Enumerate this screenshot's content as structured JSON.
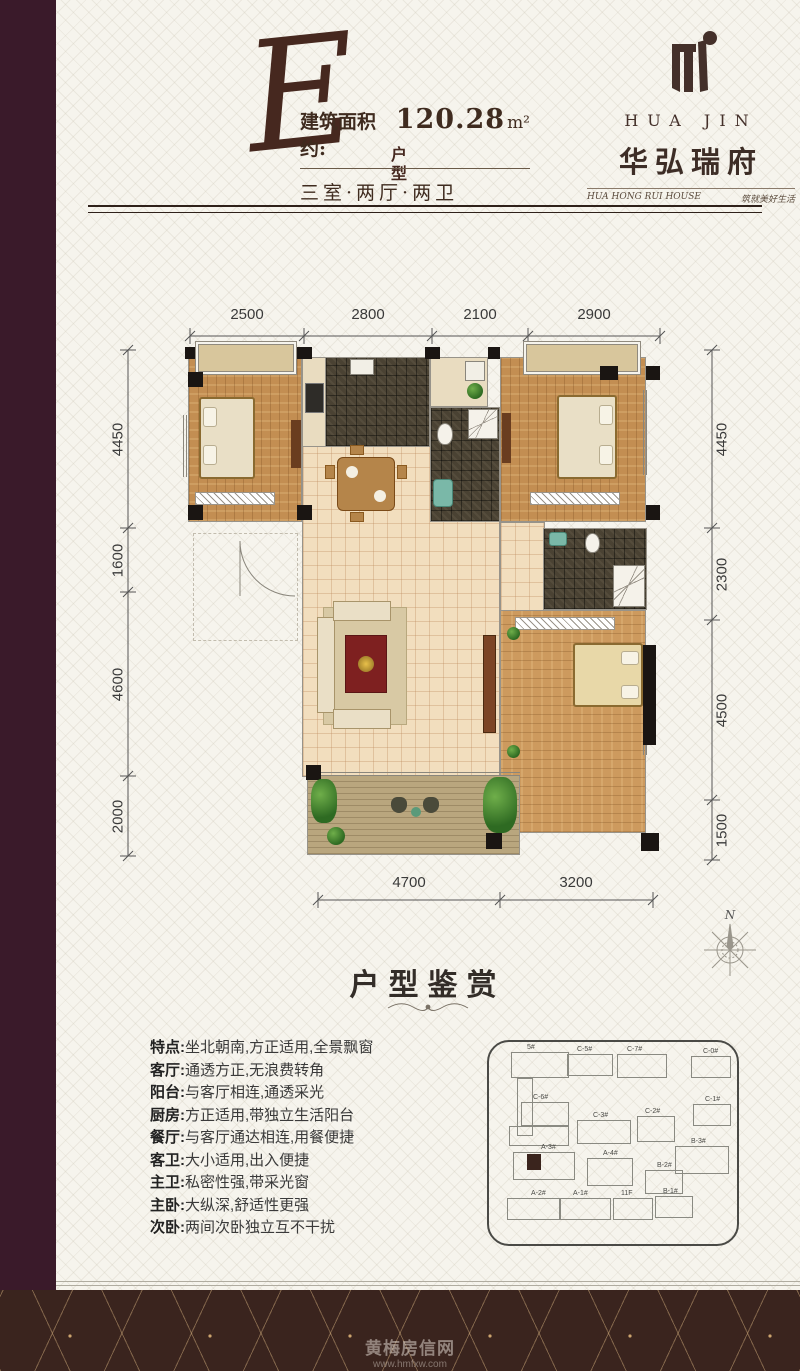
{
  "colors": {
    "accent_brown": "#46281f",
    "footer_bg": "#3a241e",
    "highlight_unit": "#3a241d"
  },
  "header": {
    "unit_letter": "E",
    "unit_suffix": "户型",
    "area_label": "建筑面积约:",
    "area_value": "120.28",
    "area_unit": "m²",
    "layout": "三室·两厅·两卫"
  },
  "brand": {
    "logo_icon": "hua-jin-monogram",
    "name_en": "HUA JIN",
    "name_cn": "华弘瑞府",
    "tagline_en": "HUA HONG RUI HOUSE",
    "tagline_cn": "筑就美好生活"
  },
  "floorplan": {
    "compass": "N",
    "dims_top": [
      "2500",
      "2800",
      "2100",
      "2900"
    ],
    "dims_left": [
      "4450",
      "1600",
      "4600",
      "2000"
    ],
    "dims_right": [
      "4450",
      "2300",
      "4500",
      "1500"
    ],
    "dims_bottom": [
      "4700",
      "3200"
    ]
  },
  "appreciation": {
    "title": "户型鉴赏",
    "features": [
      {
        "label": "特点:",
        "text": "坐北朝南,方正适用,全景飘窗"
      },
      {
        "label": "客厅:",
        "text": "通透方正,无浪费转角"
      },
      {
        "label": "阳台:",
        "text": "与客厅相连,通透采光"
      },
      {
        "label": "厨房:",
        "text": "方正适用,带独立生活阳台"
      },
      {
        "label": "餐厅:",
        "text": "与客厅通达相连,用餐便捷"
      },
      {
        "label": "客卫:",
        "text": "大小适用,出入便捷"
      },
      {
        "label": "主卫:",
        "text": "私密性强,带采光窗"
      },
      {
        "label": "主卧:",
        "text": "大纵深,舒适性更强"
      },
      {
        "label": "次卧:",
        "text": "两间次卧独立互不干扰"
      }
    ]
  },
  "siteplan": {
    "buildings": [
      "5#",
      "C-5#",
      "C-7#",
      "C-0#",
      "C-6#",
      "C-1#",
      "C-3#",
      "C-2#",
      "B-3#",
      "A-3#",
      "A-4#",
      "B-2#",
      "A-2#",
      "A-1#",
      "11F",
      "B-1#"
    ]
  },
  "watermark": {
    "line1": "黄梅房信网",
    "line2": "www.hmfxw.com"
  }
}
